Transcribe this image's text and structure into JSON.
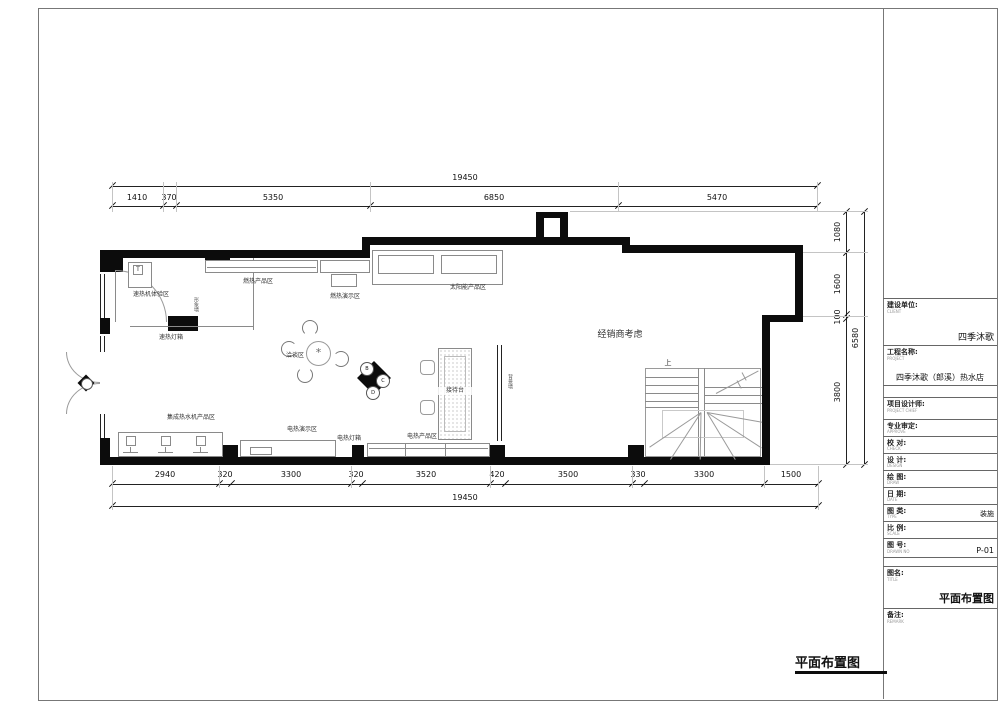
{
  "sheet": {
    "bottom_title": "平面布置图",
    "title_block": {
      "rows": [
        {
          "label": "建设单位:",
          "sub": "CLIENT",
          "value": "四季沐歌"
        },
        {
          "label": "工程名称:",
          "sub": "PROJECT",
          "value": "四季沐歌（郎溪）热水店"
        },
        {
          "label": "",
          "sub": "",
          "value": ""
        },
        {
          "label": "项目设计师:",
          "sub": "PROJECT CHIEF",
          "value": ""
        },
        {
          "label": "专业审定:",
          "sub": "APPROVE",
          "value": ""
        },
        {
          "label": "校 对:",
          "sub": "CHECK",
          "value": ""
        },
        {
          "label": "设 计:",
          "sub": "DESIGN",
          "value": ""
        },
        {
          "label": "绘 图:",
          "sub": "DRAW",
          "value": ""
        },
        {
          "label": "日 期:",
          "sub": "DATE",
          "value": ""
        },
        {
          "label": "图 类:",
          "sub": "TYPE",
          "value": "装施"
        },
        {
          "label": "比 例:",
          "sub": "SCALE",
          "value": ""
        },
        {
          "label": "图 号:",
          "sub": "DRAWN NO",
          "value": "P-01"
        },
        {
          "label": "",
          "sub": "",
          "value": ""
        },
        {
          "label": "图名:",
          "sub": "TITLE",
          "value": "平面布置图"
        },
        {
          "label": "备注:",
          "sub": "REMARK",
          "value": ""
        }
      ]
    }
  },
  "plan": {
    "zones": {
      "experience": "速热机体验区",
      "lightbox_left": "速热灯箱",
      "gas_products": "燃热产品区",
      "gas_demo": "燃热演示区",
      "solar_products": "太阳能产品区",
      "negotiation": "洽谈区",
      "reception": "接待台",
      "integrated_products": "集成热水机产品区",
      "electric_demo": "电热演示区",
      "electric_lightbox": "电热灯箱",
      "electric_products": "电热产品区"
    },
    "wall_notes": {
      "image_wall": "形象墙",
      "background_wall": "背景墙"
    },
    "dealer_note": "经销商考虑",
    "stair_up": "上",
    "equipment_tag": "T",
    "plant_glyph": "*",
    "elevation_marks": {
      "b": "B",
      "c": "C",
      "d": "D"
    }
  },
  "dims": {
    "top_total": "19450",
    "top": [
      "1410",
      "370",
      "5350",
      "6850",
      "5470"
    ],
    "bottom": [
      "2940",
      "320",
      "3300",
      "320",
      "3520",
      "420",
      "3500",
      "330",
      "3300",
      "1500"
    ],
    "bottom_total": "19450",
    "right": [
      "1080",
      "1600",
      "100",
      "3800"
    ],
    "right_total": "6580"
  }
}
